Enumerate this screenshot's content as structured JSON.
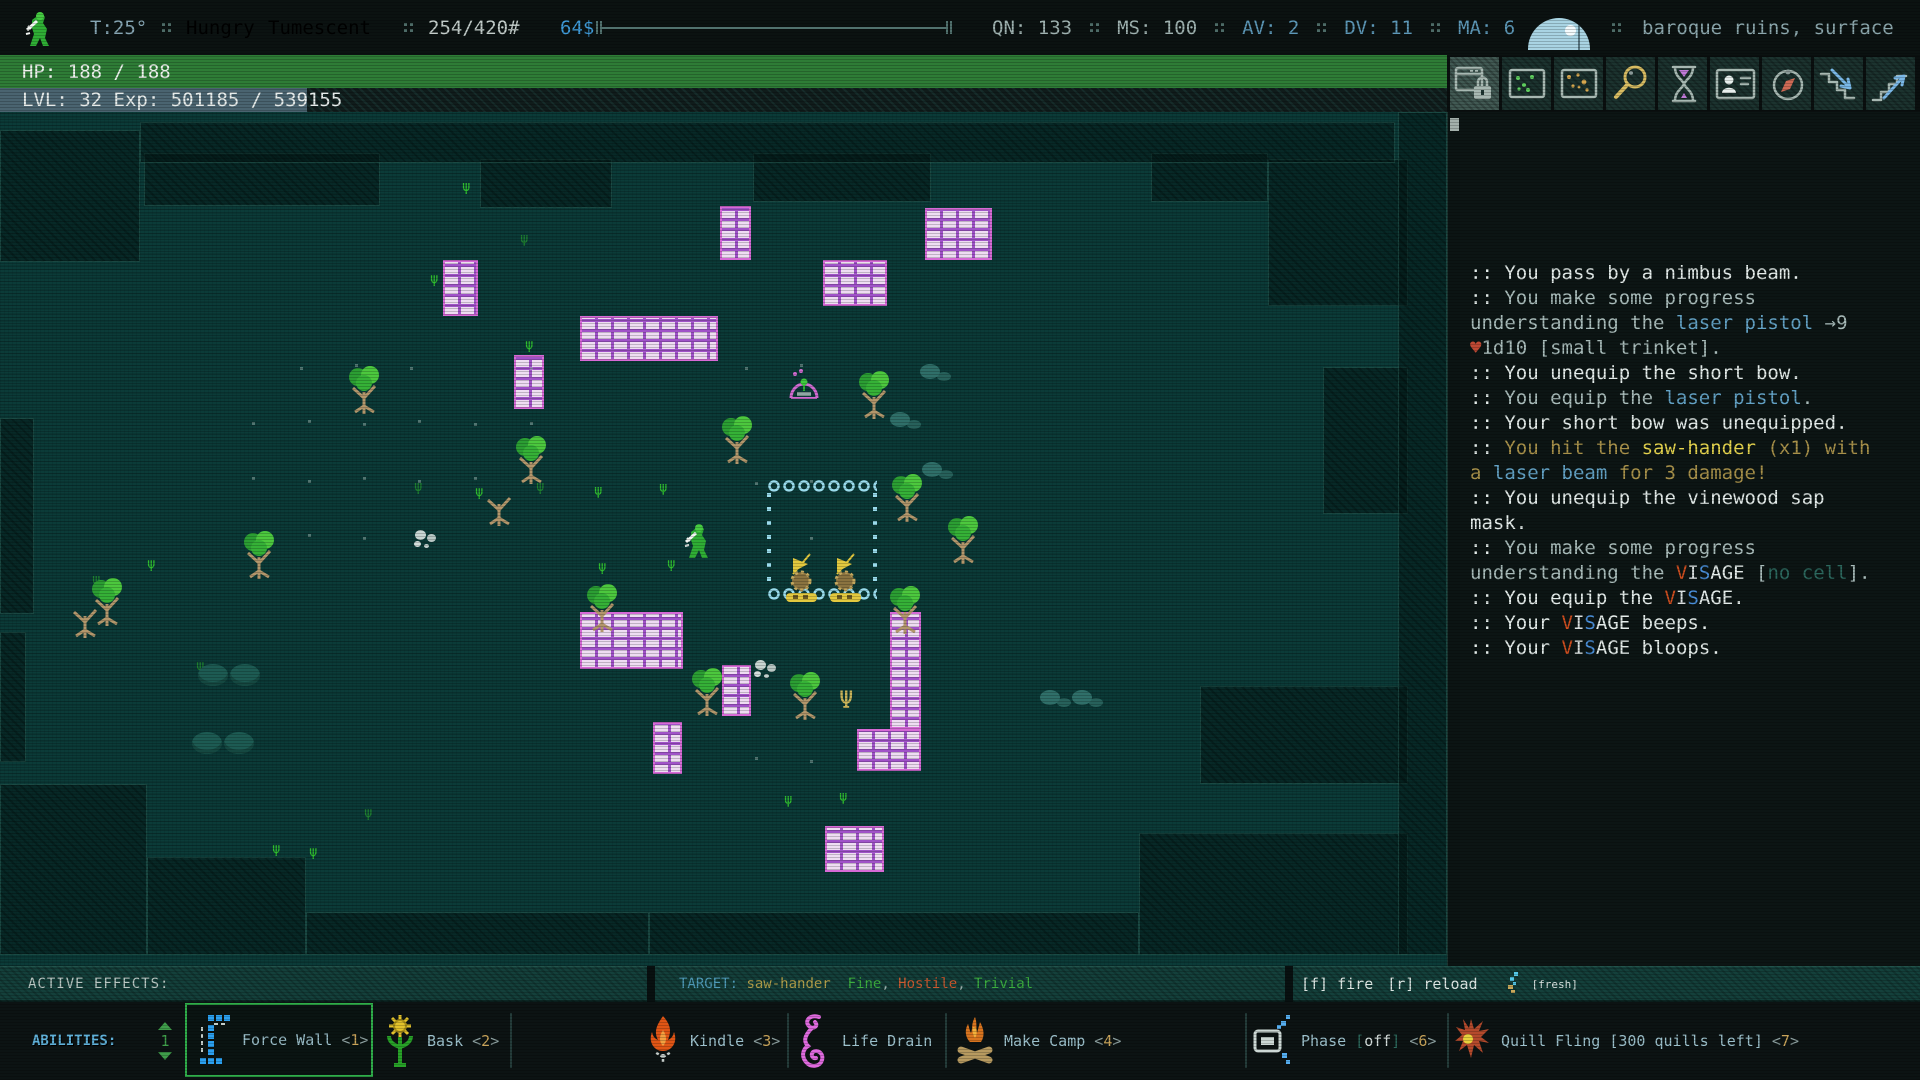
{
  "top_bar": {
    "temperature": "T:25°",
    "statuses": [
      {
        "label": "Hungry",
        "color": "#d9bd3f"
      },
      {
        "label": "Tumescent",
        "color": "#35c03a"
      }
    ],
    "weight": "254/420#",
    "money": "64$",
    "stats": [
      {
        "label": "QN:",
        "value": "133",
        "color": "#9fb2b0"
      },
      {
        "label": "MS:",
        "value": "100",
        "color": "#9fb2b0"
      },
      {
        "label": "AV:",
        "value": "2",
        "color": "#5d98b8"
      },
      {
        "label": "DV:",
        "value": "11",
        "color": "#5d98b8"
      },
      {
        "label": "MA:",
        "value": "6",
        "color": "#5d98b8"
      }
    ],
    "location": "baroque ruins, surface"
  },
  "hp_bar": {
    "label": "HP: 188 / 188",
    "color": "#2e7c36"
  },
  "level_bar": {
    "text": "LVL: 32 Exp: 501185 / 539155",
    "highlight_px": 307
  },
  "toolbar": {
    "buttons": [
      {
        "name": "lock-interface",
        "icon": "window-lock",
        "active": true
      },
      {
        "name": "local-map",
        "icon": "map-dots-green",
        "active": false
      },
      {
        "name": "world-map",
        "icon": "map-dots-gold",
        "active": false
      },
      {
        "name": "zoom-view",
        "icon": "magnifier",
        "active": false
      },
      {
        "name": "rest",
        "icon": "hourglass",
        "active": false
      },
      {
        "name": "character-sheet",
        "icon": "id-card",
        "active": false
      },
      {
        "name": "journal",
        "icon": "compass",
        "active": false
      },
      {
        "name": "stairs-down",
        "icon": "stairs-down",
        "active": false
      },
      {
        "name": "stairs-up",
        "icon": "stairs-up",
        "active": false
      }
    ]
  },
  "log_colors": {
    "w": "#e4ecea",
    "g": "#a9bcba",
    "b": "#63a2c5",
    "o": "#a8914a",
    "y": "#e5d44e",
    "r": "#bf4934",
    "t": "#2c685e",
    "V": "#cf4e1f",
    "I": "#d9dfdf",
    "S": "#4a8fd9"
  },
  "message_log": {
    "lines": [
      [
        [
          ":: You pass by a nimbus beam.",
          "w"
        ]
      ],
      [
        [
          ":: ",
          "w"
        ],
        [
          "You make some progress",
          "g"
        ]
      ],
      [
        [
          "understanding the ",
          "g"
        ],
        [
          "laser pistol",
          "b"
        ],
        [
          " →9",
          "g"
        ]
      ],
      [
        [
          "♥",
          "r"
        ],
        [
          "1d10 [small trinket].",
          "g"
        ]
      ],
      [
        [
          ":: You unequip the short bow.",
          "w"
        ]
      ],
      [
        [
          ":: ",
          "w"
        ],
        [
          "You equip the ",
          "g"
        ],
        [
          "laser pistol",
          "b"
        ],
        [
          ".",
          "g"
        ]
      ],
      [
        [
          ":: Your short bow was unequipped.",
          "w"
        ]
      ],
      [
        [
          ":: ",
          "w"
        ],
        [
          "You hit the ",
          "o"
        ],
        [
          "saw-hander",
          "y"
        ],
        [
          " (x1) with",
          "o"
        ]
      ],
      [
        [
          "a ",
          "o"
        ],
        [
          "laser beam",
          "b"
        ],
        [
          " for 3 damage!",
          "o"
        ]
      ],
      [
        [
          ":: You unequip the vinewood sap",
          "w"
        ]
      ],
      [
        [
          "mask.",
          "w"
        ]
      ],
      [
        [
          ":: ",
          "w"
        ],
        [
          "You make some progress",
          "g"
        ]
      ],
      [
        [
          "understanding the ",
          "g"
        ],
        [
          "V",
          "V"
        ],
        [
          "I",
          "I"
        ],
        [
          "S",
          "S"
        ],
        [
          "AGE",
          "w"
        ],
        [
          " [",
          "g"
        ],
        [
          "no cell",
          "t"
        ],
        [
          "].",
          "g"
        ]
      ],
      [
        [
          ":: You equip the ",
          "w"
        ],
        [
          "V",
          "V"
        ],
        [
          "I",
          "I"
        ],
        [
          "S",
          "S"
        ],
        [
          "AGE",
          "w"
        ],
        [
          ".",
          "w"
        ]
      ],
      [
        [
          ":: Your ",
          "w"
        ],
        [
          "V",
          "V"
        ],
        [
          "I",
          "I"
        ],
        [
          "S",
          "S"
        ],
        [
          "AGE",
          "w"
        ],
        [
          " beeps.",
          "w"
        ]
      ],
      [
        [
          ":: Your ",
          "w"
        ],
        [
          "V",
          "V"
        ],
        [
          "I",
          "I"
        ],
        [
          "S",
          "S"
        ],
        [
          "AGE",
          "w"
        ],
        [
          " bloops.",
          "w"
        ]
      ]
    ]
  },
  "status_bars": {
    "active_effects_label": "ACTIVE EFFECTS:",
    "target_segments": [
      [
        "TARGET: ",
        "#4f9ab8"
      ],
      [
        "saw-hander ",
        "#b3a04b"
      ],
      [
        " Fine",
        "#3cae3f"
      ],
      [
        ", ",
        "#9ab0ac"
      ],
      [
        "Hostile",
        "#cb5a30"
      ],
      [
        ", ",
        "#9ab0ac"
      ],
      [
        "Trivial",
        "#3cae3f"
      ]
    ],
    "fire_hint": "[f] fire",
    "reload_hint": "[r] reload",
    "cell_status": "[fresh]"
  },
  "abilities": {
    "label": "ABILITIES:",
    "page": "1",
    "separators": [
      510,
      787,
      945,
      1245,
      1447
    ],
    "items": [
      {
        "label": "Force Wall",
        "hotkey": "<1>",
        "icon": "force-wall",
        "selected": true,
        "x": 185
      },
      {
        "label": "Bask",
        "hotkey": "<2>",
        "icon": "bask",
        "selected": false,
        "x": 382
      },
      {
        "label": "Kindle",
        "hotkey": "<3>",
        "icon": "kindle",
        "selected": false,
        "x": 645
      },
      {
        "label": "Life Drain",
        "hotkey": "",
        "icon": "life-drain",
        "selected": false,
        "x": 797
      },
      {
        "label": "Make Camp",
        "hotkey": "<4>",
        "icon": "make-camp",
        "selected": false,
        "x": 955
      },
      {
        "label": "Phase",
        "state": "[off]",
        "hotkey": "<6>",
        "icon": "phase",
        "selected": false,
        "x": 1252
      },
      {
        "label": "Quill Fling",
        "extra": "[300 quills left]",
        "hotkey": "<7>",
        "icon": "quill-fling",
        "selected": false,
        "x": 1452
      }
    ]
  },
  "map": {
    "rooms": [
      [
        0,
        18,
        140,
        132
      ],
      [
        144,
        41,
        236,
        53
      ],
      [
        480,
        47,
        132,
        49
      ],
      [
        753,
        41,
        178,
        49
      ],
      [
        1151,
        41,
        117,
        49
      ],
      [
        1268,
        47,
        140,
        147
      ],
      [
        1323,
        255,
        85,
        147
      ],
      [
        0,
        672,
        147,
        171
      ],
      [
        147,
        745,
        159,
        98
      ],
      [
        306,
        800,
        343,
        43
      ],
      [
        649,
        800,
        490,
        43
      ],
      [
        1139,
        721,
        269,
        122
      ],
      [
        1200,
        574,
        208,
        98
      ],
      [
        0,
        306,
        34,
        196
      ],
      [
        0,
        520,
        26,
        130
      ],
      [
        140,
        10,
        1255,
        41
      ],
      [
        1398,
        0,
        49,
        843
      ]
    ],
    "walls": [
      [
        443,
        148,
        35,
        56
      ],
      [
        720,
        94,
        31,
        54
      ],
      [
        925,
        96,
        67,
        52
      ],
      [
        823,
        148,
        64,
        46
      ],
      [
        580,
        204,
        138,
        45
      ],
      [
        514,
        243,
        30,
        54
      ],
      [
        580,
        500,
        103,
        57
      ],
      [
        722,
        553,
        29,
        51
      ],
      [
        890,
        500,
        31,
        117
      ],
      [
        857,
        617,
        64,
        42
      ],
      [
        653,
        610,
        29,
        52
      ],
      [
        825,
        714,
        59,
        46
      ]
    ],
    "trees": [
      [
        345,
        250,
        "g"
      ],
      [
        512,
        320,
        "g"
      ],
      [
        480,
        362,
        "d"
      ],
      [
        240,
        415,
        "g"
      ],
      [
        88,
        462,
        "g"
      ],
      [
        583,
        468,
        "g"
      ],
      [
        718,
        300,
        "g"
      ],
      [
        855,
        255,
        "g"
      ],
      [
        888,
        358,
        "g"
      ],
      [
        944,
        400,
        "g"
      ],
      [
        688,
        552,
        "g"
      ],
      [
        786,
        556,
        "g"
      ],
      [
        886,
        470,
        "g"
      ],
      [
        66,
        474,
        "d"
      ]
    ],
    "grass": [
      [
        462,
        68,
        "#2fbe2f"
      ],
      [
        525,
        226,
        "#2fbe2f"
      ],
      [
        414,
        368,
        "#1e8030"
      ],
      [
        475,
        373,
        "#2fbe2f"
      ],
      [
        536,
        368,
        "#1e8030"
      ],
      [
        594,
        372,
        "#2fbe2f"
      ],
      [
        659,
        369,
        "#2fbe2f"
      ],
      [
        147,
        445,
        "#2fbe2f"
      ],
      [
        92,
        461,
        "#1e8030"
      ],
      [
        667,
        445,
        "#2fbe2f"
      ],
      [
        598,
        448,
        "#2fbe2f"
      ],
      [
        272,
        730,
        "#2fbe2f"
      ],
      [
        309,
        733,
        "#2fbe2f"
      ],
      [
        839,
        678,
        "#2fbe2f"
      ],
      [
        784,
        681,
        "#2fbe2f"
      ],
      [
        906,
        484,
        "#2fbe2f"
      ],
      [
        196,
        547,
        "#1e8030"
      ],
      [
        364,
        694,
        "#1e8030"
      ],
      [
        520,
        120,
        "#1e8030"
      ],
      [
        430,
        160,
        "#2fbe2f"
      ]
    ],
    "plants": [
      [
        839,
        576
      ]
    ],
    "dots": [
      [
        300,
        255
      ],
      [
        355,
        252
      ],
      [
        410,
        255
      ],
      [
        252,
        310
      ],
      [
        308,
        308
      ],
      [
        363,
        311
      ],
      [
        418,
        308
      ],
      [
        474,
        311
      ],
      [
        745,
        255
      ],
      [
        800,
        252
      ],
      [
        252,
        365
      ],
      [
        308,
        368
      ],
      [
        363,
        365
      ],
      [
        418,
        368
      ],
      [
        474,
        365
      ],
      [
        308,
        422
      ],
      [
        363,
        425
      ],
      [
        418,
        422
      ],
      [
        755,
        370
      ],
      [
        810,
        368
      ],
      [
        252,
        422
      ],
      [
        810,
        425
      ],
      [
        755,
        645
      ],
      [
        810,
        648
      ],
      [
        530,
        310
      ],
      [
        530,
        255
      ]
    ],
    "smoke_white": [
      [
        415,
        418
      ],
      [
        755,
        548
      ]
    ],
    "smoke_teal": [
      [
        920,
        252
      ],
      [
        890,
        300
      ],
      [
        922,
        350
      ],
      [
        1040,
        578
      ],
      [
        1072,
        578
      ]
    ],
    "boulders": [
      [
        198,
        552
      ],
      [
        230,
        552
      ],
      [
        192,
        620
      ],
      [
        224,
        620
      ]
    ],
    "pen": {
      "x": 767,
      "y": 365,
      "w": 110,
      "h": 126
    },
    "saws": [
      [
        783,
        440
      ],
      [
        827,
        440
      ]
    ],
    "player": {
      "x": 683,
      "y": 408
    },
    "nimbus": {
      "x": 786,
      "y": 256
    }
  }
}
